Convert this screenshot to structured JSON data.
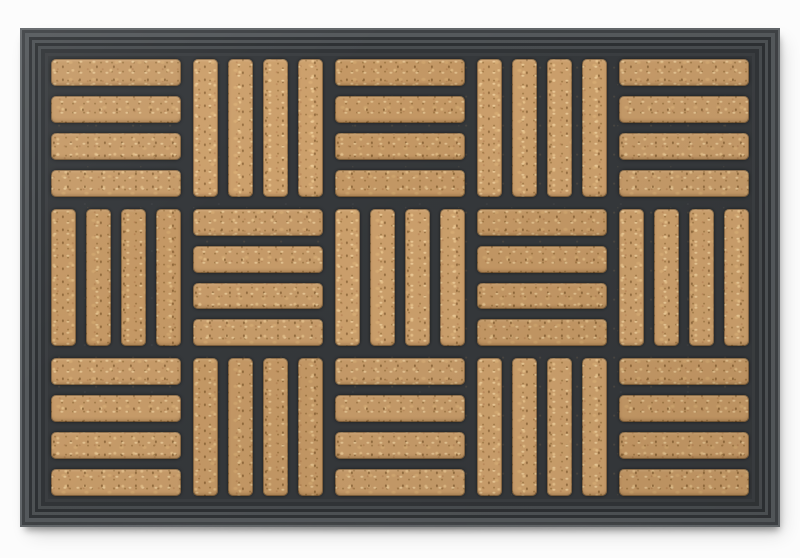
{
  "scene": {
    "type": "product-photo",
    "subject": "rectangular doormat, black rubber frame with coir inlay",
    "background_color": "#fcfcfc"
  },
  "mat": {
    "materials": {
      "stripes": "coir (coconut fibre)",
      "body": "rubber"
    },
    "colors": {
      "coir_base": "#c69b69",
      "coir_light": "#e4c492",
      "coir_dark": "#8a6438",
      "rubber": "#36393c",
      "ridge_light": "#63676a",
      "ridge_dark": "#2d3033",
      "background": "#fcfcfc"
    },
    "frame": {
      "style": "concentric ribbed rubber border, mitered corners",
      "ridge_count": 5
    },
    "pattern": {
      "description": "parquet basketweave: checkerboard of blocks, each block holds 4 parallel coir stripes set in rubber channels",
      "rows": 3,
      "cols": 5,
      "stripes_per_block": 4,
      "orientation_grid": [
        [
          "H",
          "V",
          "H",
          "V",
          "H"
        ],
        [
          "V",
          "H",
          "V",
          "H",
          "V"
        ],
        [
          "H",
          "V",
          "H",
          "V",
          "H"
        ]
      ]
    }
  }
}
